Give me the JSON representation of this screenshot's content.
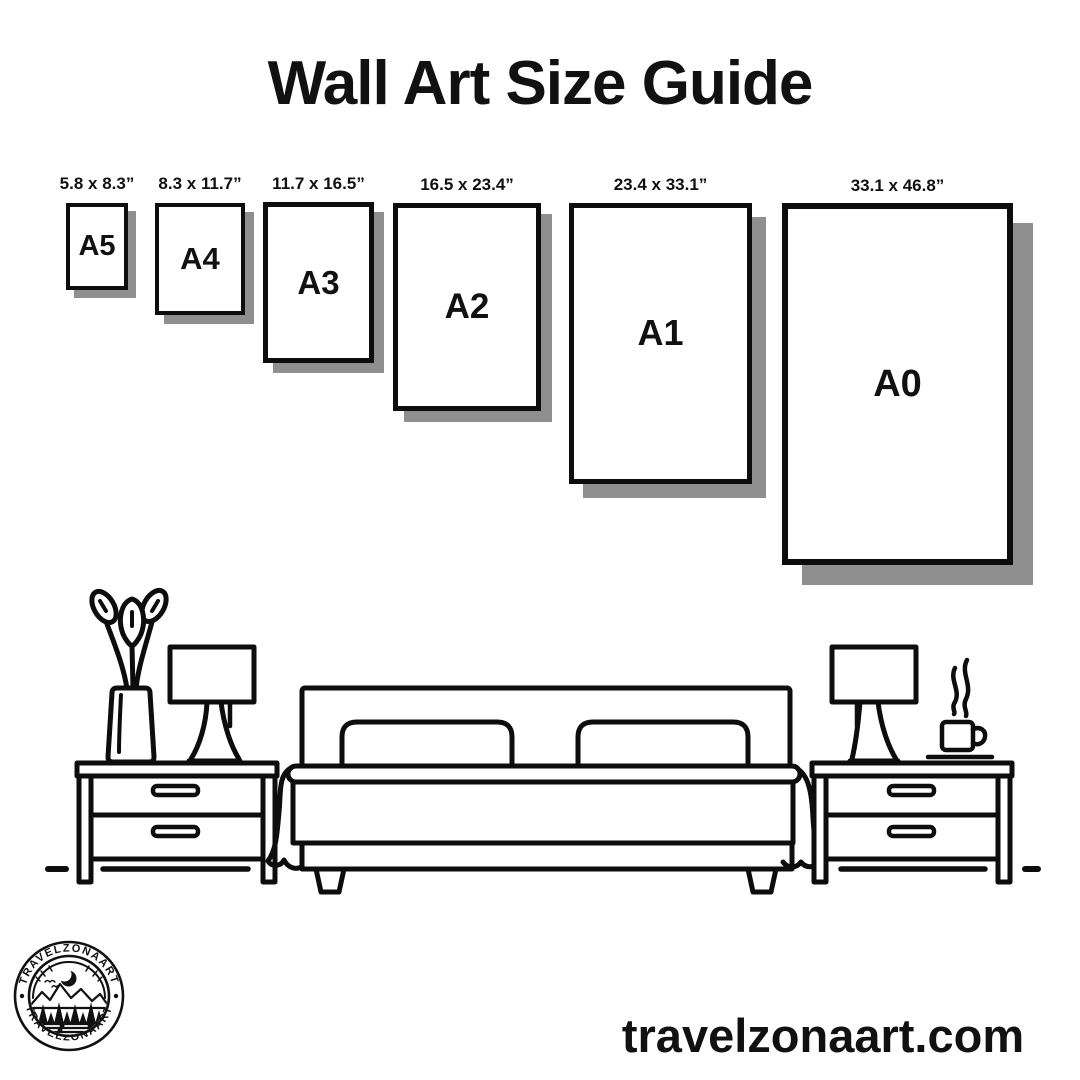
{
  "title": "Wall Art Size Guide",
  "papers": [
    {
      "name": "A5",
      "dimensions": "5.8 x 8.3”"
    },
    {
      "name": "A4",
      "dimensions": "8.3 x 11.7”"
    },
    {
      "name": "A3",
      "dimensions": "11.7 x 16.5”"
    },
    {
      "name": "A2",
      "dimensions": "16.5 x 23.4”"
    },
    {
      "name": "A1",
      "dimensions": "23.4 x 33.1”"
    },
    {
      "name": "A0",
      "dimensions": "33.1 x 46.8”"
    }
  ],
  "logo": {
    "arc_text_top": "TRAVELZONAART",
    "arc_text_bottom": "TRAVELZONAART"
  },
  "footer": {
    "website": "travelzonaart.com"
  },
  "colors": {
    "ink": "#0d0d0d",
    "shadow": "#8f8f8f",
    "background": "#ffffff"
  }
}
